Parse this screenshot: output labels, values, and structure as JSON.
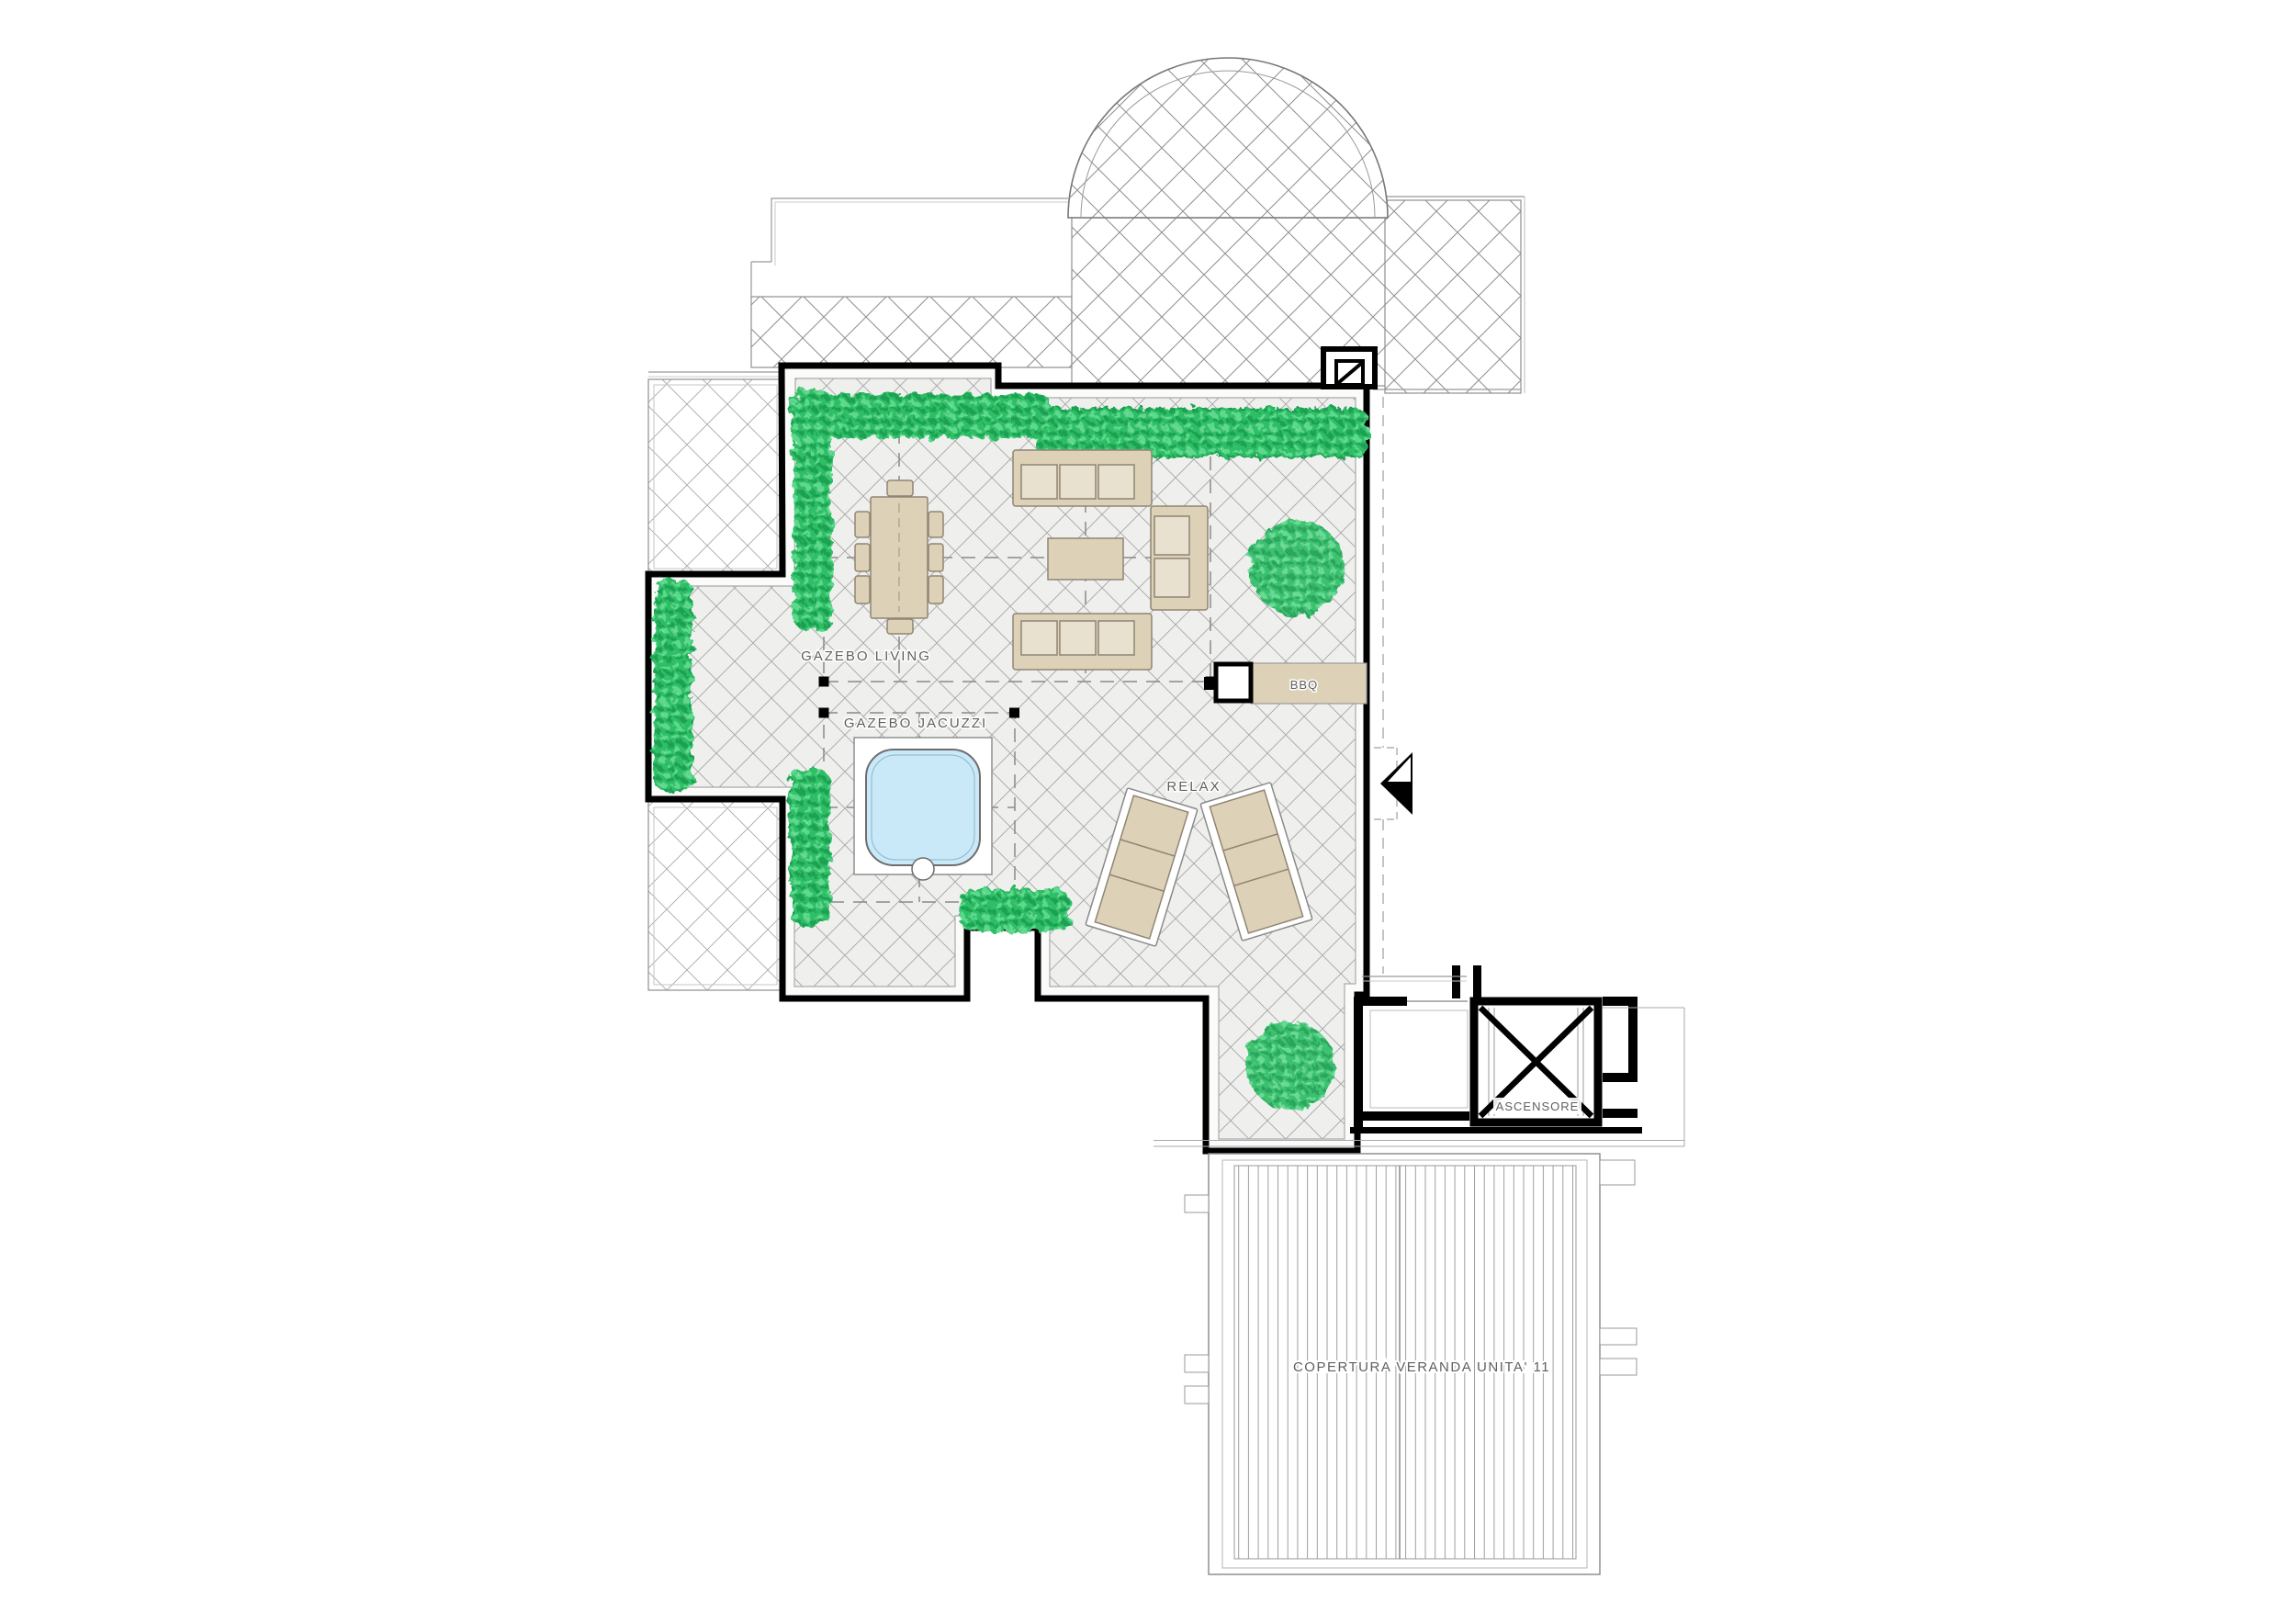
{
  "plan": {
    "labels": {
      "gazebo_living": "GAZEBO LIVING",
      "gazebo_jacuzzi": "GAZEBO JACUZZI",
      "relax": "RELAX",
      "bbq": "BBQ",
      "elevator": "ASCENSORE",
      "veranda": "COPERTURA VERANDA UNITA' 11"
    },
    "colors": {
      "wall": "#000000",
      "line": "#8f8f8f",
      "line_light": "#b5b5b5",
      "terrace_bg": "#f0f0ef",
      "hatch": "#a4a4a4",
      "furniture": "#ddd2b8",
      "furniture_light": "#e9e1cf",
      "furniture_edge": "#8f8573",
      "hedge": "#2fbf66",
      "hedge_dark": "#1fa053",
      "hedge_light": "#5cd98d",
      "pool": "#c9e8f8",
      "label_text": "#5f5f5f"
    }
  }
}
